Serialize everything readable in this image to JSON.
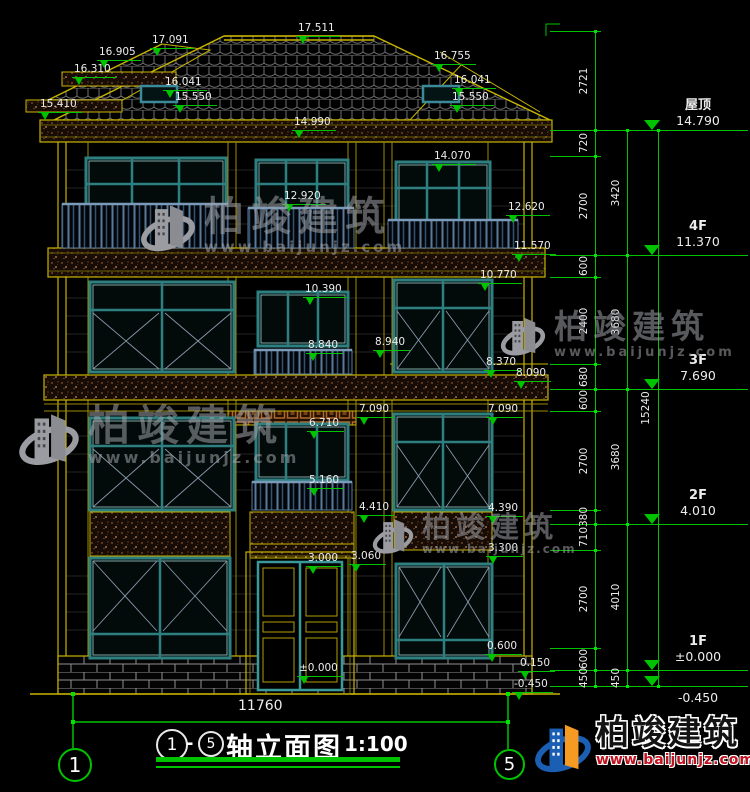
{
  "drawing_title": {
    "axis_from": "1",
    "axis_to": "5",
    "dash": "-",
    "name": "轴立面图",
    "scale": "1:100"
  },
  "overall_dim": "11760",
  "axis_bubbles": {
    "left": "1",
    "right": "5"
  },
  "brand": {
    "name": "柏竣建筑",
    "url": "www.baijunjz.com"
  },
  "levels": [
    {
      "label": "屋顶",
      "value": "14.790",
      "y": 130
    },
    {
      "label": "4F",
      "value": "11.370",
      "y": 255
    },
    {
      "label": "3F",
      "value": "7.690",
      "y": 389
    },
    {
      "label": "2F",
      "value": "4.010",
      "y": 524
    },
    {
      "label": "1F",
      "value": "±0.000",
      "y": 670
    },
    {
      "label": "",
      "value": "-0.450",
      "y": 686,
      "below": true
    }
  ],
  "dim_columns": [
    {
      "x": 595,
      "text_x": 584,
      "tick_left": 550,
      "segments": [
        {
          "v": "2721",
          "y1": 31,
          "y2": 130
        },
        {
          "v": "720",
          "y1": 130,
          "y2": 156
        },
        {
          "v": "2700",
          "y1": 156,
          "y2": 255
        },
        {
          "v": "600",
          "y1": 255,
          "y2": 277
        },
        {
          "v": "2400",
          "y1": 277,
          "y2": 364
        },
        {
          "v": "680",
          "y1": 364,
          "y2": 389
        },
        {
          "v": "600",
          "y1": 389,
          "y2": 411
        },
        {
          "v": "2700",
          "y1": 411,
          "y2": 510
        },
        {
          "v": "380",
          "y1": 510,
          "y2": 524
        },
        {
          "v": "710",
          "y1": 524,
          "y2": 550
        },
        {
          "v": "2700",
          "y1": 550,
          "y2": 648
        },
        {
          "v": "600",
          "y1": 648,
          "y2": 670
        },
        {
          "v": "450",
          "y1": 670,
          "y2": 686
        }
      ]
    },
    {
      "x": 627,
      "text_x": 616,
      "tick_left": 596,
      "segments": [
        {
          "v": "3420",
          "y1": 130,
          "y2": 255
        },
        {
          "v": "3680",
          "y1": 255,
          "y2": 389
        },
        {
          "v": "3680",
          "y1": 389,
          "y2": 524
        },
        {
          "v": "4010",
          "y1": 524,
          "y2": 670
        },
        {
          "v": "450",
          "y1": 670,
          "y2": 686
        }
      ]
    },
    {
      "x": 658,
      "text_x": 646,
      "tick_left": 596,
      "segments": [
        {
          "v": "15240",
          "y1": 130,
          "y2": 686
        }
      ]
    }
  ],
  "elevation_markers": [
    {
      "v": "17.511",
      "x": 296,
      "y": 16
    },
    {
      "v": "17.091",
      "x": 150,
      "y": 28
    },
    {
      "v": "16.905",
      "x": 97,
      "y": 40
    },
    {
      "v": "16.310",
      "x": 72,
      "y": 57
    },
    {
      "v": "16.041",
      "x": 163,
      "y": 70
    },
    {
      "v": "15.550",
      "x": 173,
      "y": 85
    },
    {
      "v": "15.410",
      "x": 38,
      "y": 92
    },
    {
      "v": "16.755",
      "x": 432,
      "y": 44
    },
    {
      "v": "16.041",
      "x": 452,
      "y": 68
    },
    {
      "v": "15.550",
      "x": 450,
      "y": 85
    },
    {
      "v": "14.990",
      "x": 292,
      "y": 110
    },
    {
      "v": "14.070",
      "x": 432,
      "y": 144
    },
    {
      "v": "12.920",
      "x": 282,
      "y": 184
    },
    {
      "v": "12.620",
      "x": 506,
      "y": 195
    },
    {
      "v": "11.570",
      "x": 512,
      "y": 234
    },
    {
      "v": "10.770",
      "x": 478,
      "y": 263
    },
    {
      "v": "10.390",
      "x": 303,
      "y": 277
    },
    {
      "v": "8.840",
      "x": 306,
      "y": 333
    },
    {
      "v": "8.940",
      "x": 373,
      "y": 330
    },
    {
      "v": "8.370",
      "x": 484,
      "y": 350
    },
    {
      "v": "8.090",
      "x": 514,
      "y": 361
    },
    {
      "v": "7.090",
      "x": 357,
      "y": 397
    },
    {
      "v": "7.090",
      "x": 486,
      "y": 397
    },
    {
      "v": "6.710",
      "x": 307,
      "y": 411
    },
    {
      "v": "5.160",
      "x": 307,
      "y": 468
    },
    {
      "v": "4.410",
      "x": 357,
      "y": 495
    },
    {
      "v": "4.390",
      "x": 486,
      "y": 496
    },
    {
      "v": "3.300",
      "x": 486,
      "y": 536
    },
    {
      "v": "3.060",
      "x": 349,
      "y": 544
    },
    {
      "v": "3.000",
      "x": 306,
      "y": 546
    },
    {
      "v": "0.600",
      "x": 485,
      "y": 634
    },
    {
      "v": "0.150",
      "x": 518,
      "y": 651
    },
    {
      "v": "±0.000",
      "x": 297,
      "y": 656
    },
    {
      "v": "-0.450",
      "x": 512,
      "y": 672
    }
  ]
}
